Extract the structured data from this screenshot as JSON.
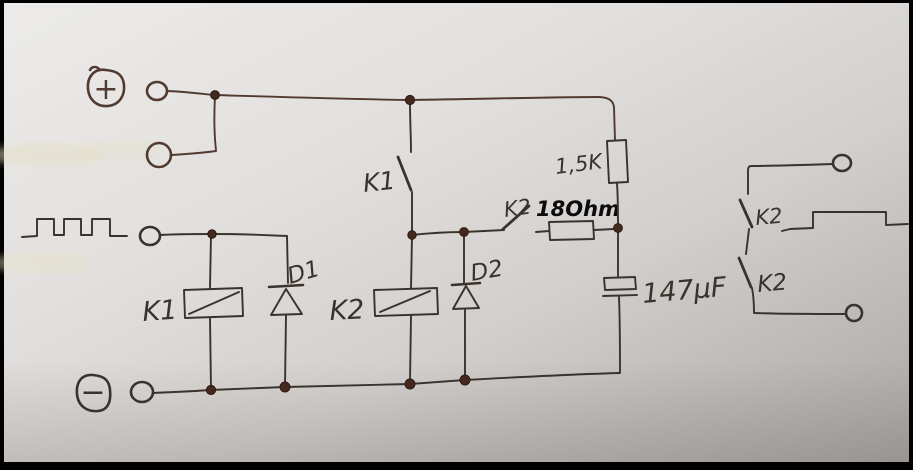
{
  "schematic": {
    "description": "Hand-drawn relay timer circuit photographed on paper",
    "supply": {
      "plus": "+",
      "minus": "−"
    },
    "labels": {
      "k1_coil": "K1",
      "k1_contact": "K1",
      "k2_coil": "K2",
      "k2_contact": "K2",
      "d1": "D1",
      "d2": "D2",
      "r_series": "1,5K",
      "r_charge": "18Ohm",
      "capacitor": "147µF",
      "k2_out_top": "K2",
      "k2_out_bottom": "K2"
    },
    "colors": {
      "ink": "#3a322c",
      "ink_brown": "#523a30",
      "annotation_black": "#0b0b0b",
      "paper_light": "#ecebe9",
      "paper_dark": "#a9a6a4",
      "frame": "#000000"
    }
  }
}
